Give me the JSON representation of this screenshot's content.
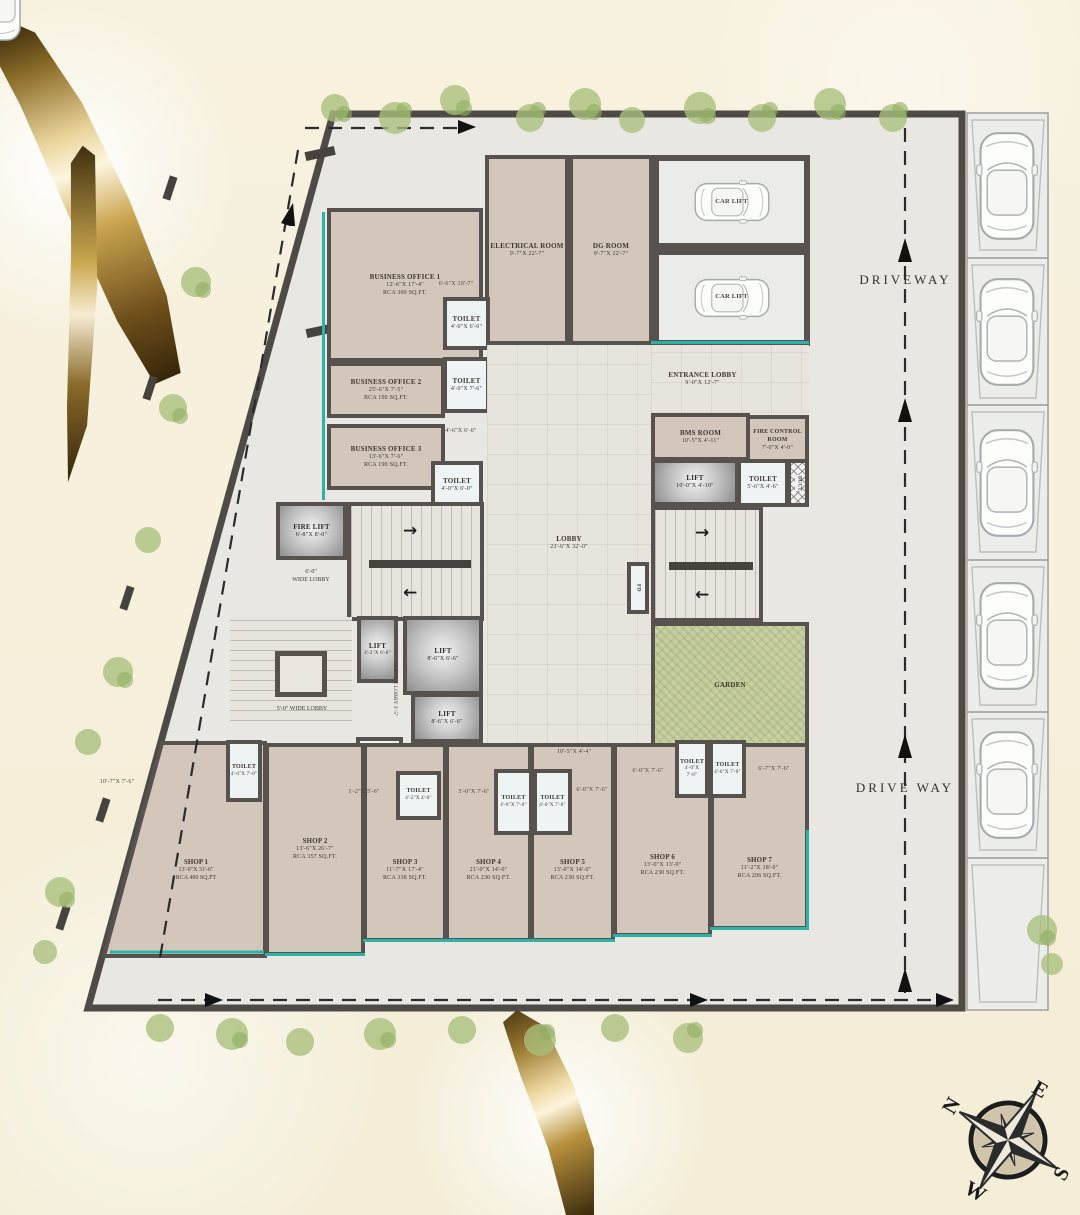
{
  "plan_title": "Ground Floor Plan",
  "colors": {
    "accent_teal": "#2bb3aa",
    "wall": "#57524d",
    "gold": "#c9a44c",
    "garden_green": "#c8cfa2"
  },
  "driveway": {
    "top": "DRIVEWAY",
    "bottom": "DRIVE WAY"
  },
  "compass": {
    "n": "N",
    "e": "E",
    "s": "S",
    "w": "W"
  },
  "rooms": {
    "electrical": {
      "name": "ELECTRICAL ROOM",
      "dim": "9'-7\"X 22'-7\""
    },
    "dg": {
      "name": "DG ROOM",
      "dim": "9'-7\"X 22'-7\""
    },
    "car_lift_1": {
      "name": "CAR LIFT"
    },
    "car_lift_2": {
      "name": "CAR LIFT"
    },
    "bo1": {
      "name": "BUSINESS OFFICE 1",
      "dim": "12'-6\"X 17'-4\"",
      "area": "RCA 300 SQ.FT."
    },
    "bo2": {
      "name": "BUSINESS OFFICE 2",
      "dim": "25'-6\"X 7'-5\"",
      "area": "RCA 190 SQ.FT."
    },
    "bo3": {
      "name": "BUSINESS OFFICE 3",
      "dim": "13'-6\"X 7'-6\"",
      "area": "RCA 190 SQ.FT."
    },
    "toilet_bo1": {
      "name": "TOILET",
      "dim": "4'-0\"X 6'-0\""
    },
    "toilet_bo2": {
      "name": "TOILET",
      "dim": "4'-0\"X 7'-6\""
    },
    "toilet_bo3": {
      "name": "TOILET",
      "dim": "4'-0\"X 6'-0\""
    },
    "fire_lift": {
      "name": "FIRE LIFT",
      "dim": "6'-8\"X 8'-0\""
    },
    "wide_lobby_6": {
      "line1": "6'-0\"",
      "line2": "WIDE LOBBY"
    },
    "lobby": {
      "name": "LOBBY",
      "dim": "23'-6\"X 32'-0\""
    },
    "entrance": {
      "name": "ENTRANCE LOBBY",
      "dim": "9'-0\"X 12'-7\""
    },
    "bms": {
      "name": "BMS ROOM",
      "dim": "10'-5\"X 4'-11\""
    },
    "fire_control": {
      "name": "FIRE CONTROL ROOM",
      "dim": "7'-0\"X 4'-0\""
    },
    "lift_r": {
      "name": "LIFT",
      "dim": "10'-0\"X 4'-10\""
    },
    "toilet_r": {
      "name": "TOILET",
      "dim": "5'-6\"X 4'-6\""
    },
    "duct": {
      "name": "DUCT"
    },
    "fd_strip": {
      "name": "FD"
    },
    "fd_box": {
      "name": "FD"
    },
    "garden": {
      "name": "GARDEN"
    },
    "lift_s": {
      "name": "LIFT",
      "dim": "4'-2\"X 6'-6\""
    },
    "lift_a": {
      "name": "LIFT",
      "dim": "8'-6\"X 6'-6\""
    },
    "lift_b": {
      "name": "LIFT",
      "dim": "8'-6\"X 6'-6\""
    },
    "service_lobby": {
      "name": "SERVICE LOBBY 3'-5\""
    },
    "wide_lobby_5": {
      "name": "5'-0\" WIDE LOBBY"
    },
    "toilet_mid": {
      "name": "TOILET",
      "dim": "6'-0\"X 3'-10\""
    }
  },
  "shops": {
    "s1": {
      "name": "SHOP 1",
      "dim": "13'-9\"X 31'-6\"",
      "area": "RCA 400 SQ.FT"
    },
    "s2": {
      "name": "SHOP 2",
      "dim": "13'-6\"X 26'-7\"",
      "area": "RCA 357 SQ.FT."
    },
    "s3": {
      "name": "SHOP 3",
      "dim": "11'-7\"X 17'-4\"",
      "area": "RCA 338 SQ.FT."
    },
    "s4": {
      "name": "SHOP 4",
      "dim": "21'-0\"X 14'-0\"",
      "area": "RCA 230 SQ.FT."
    },
    "s5": {
      "name": "SHOP 5",
      "dim": "13'-0\"X 14'-0\"",
      "area": "RCA 230 SQ.FT."
    },
    "s6": {
      "name": "SHOP 6",
      "dim": "13'-0\"X 13'-0\"",
      "area": "RCA 230 SQ.FT."
    },
    "s7": {
      "name": "SHOP 7",
      "dim": "11'-2\"X 18'-0\"",
      "area": "RCA 206 SQ.FT."
    }
  },
  "shop_toilets": {
    "t1": {
      "name": "TOILET",
      "dim": "4'-0\"X 7'-0\""
    },
    "t2": {
      "name": "TOILET",
      "dim": "4'-2\"X 4'-0\""
    },
    "t3": {
      "name": "TOILET",
      "dim": "4'-0\"X 7'-0\""
    },
    "t4": {
      "name": "TOILET",
      "dim": "4'-0\"X 7'-0\""
    },
    "t5": {
      "name": "TOILET",
      "dim": "4'-0\"X 7'-0\""
    },
    "t6": {
      "name": "TOILET",
      "dim": "4'-6\"X 7'-0\""
    }
  },
  "dims": {
    "d1": "6'-6\"X 10'-7\"",
    "d2": "4'-6\"X 6'-0\"",
    "d3": "10'-7\"X 7'-6\"",
    "d4": "1'-2\"X 5'-6\"",
    "d5": "5'-0\"X 7'-6\"",
    "d6": "6'-0\"X 7'-6\"",
    "d7": "6'-0\"X 7'-6\"",
    "d8": "6'-7\"X 7'-6\"",
    "d9": "10'-5\"X 4'-4\""
  }
}
